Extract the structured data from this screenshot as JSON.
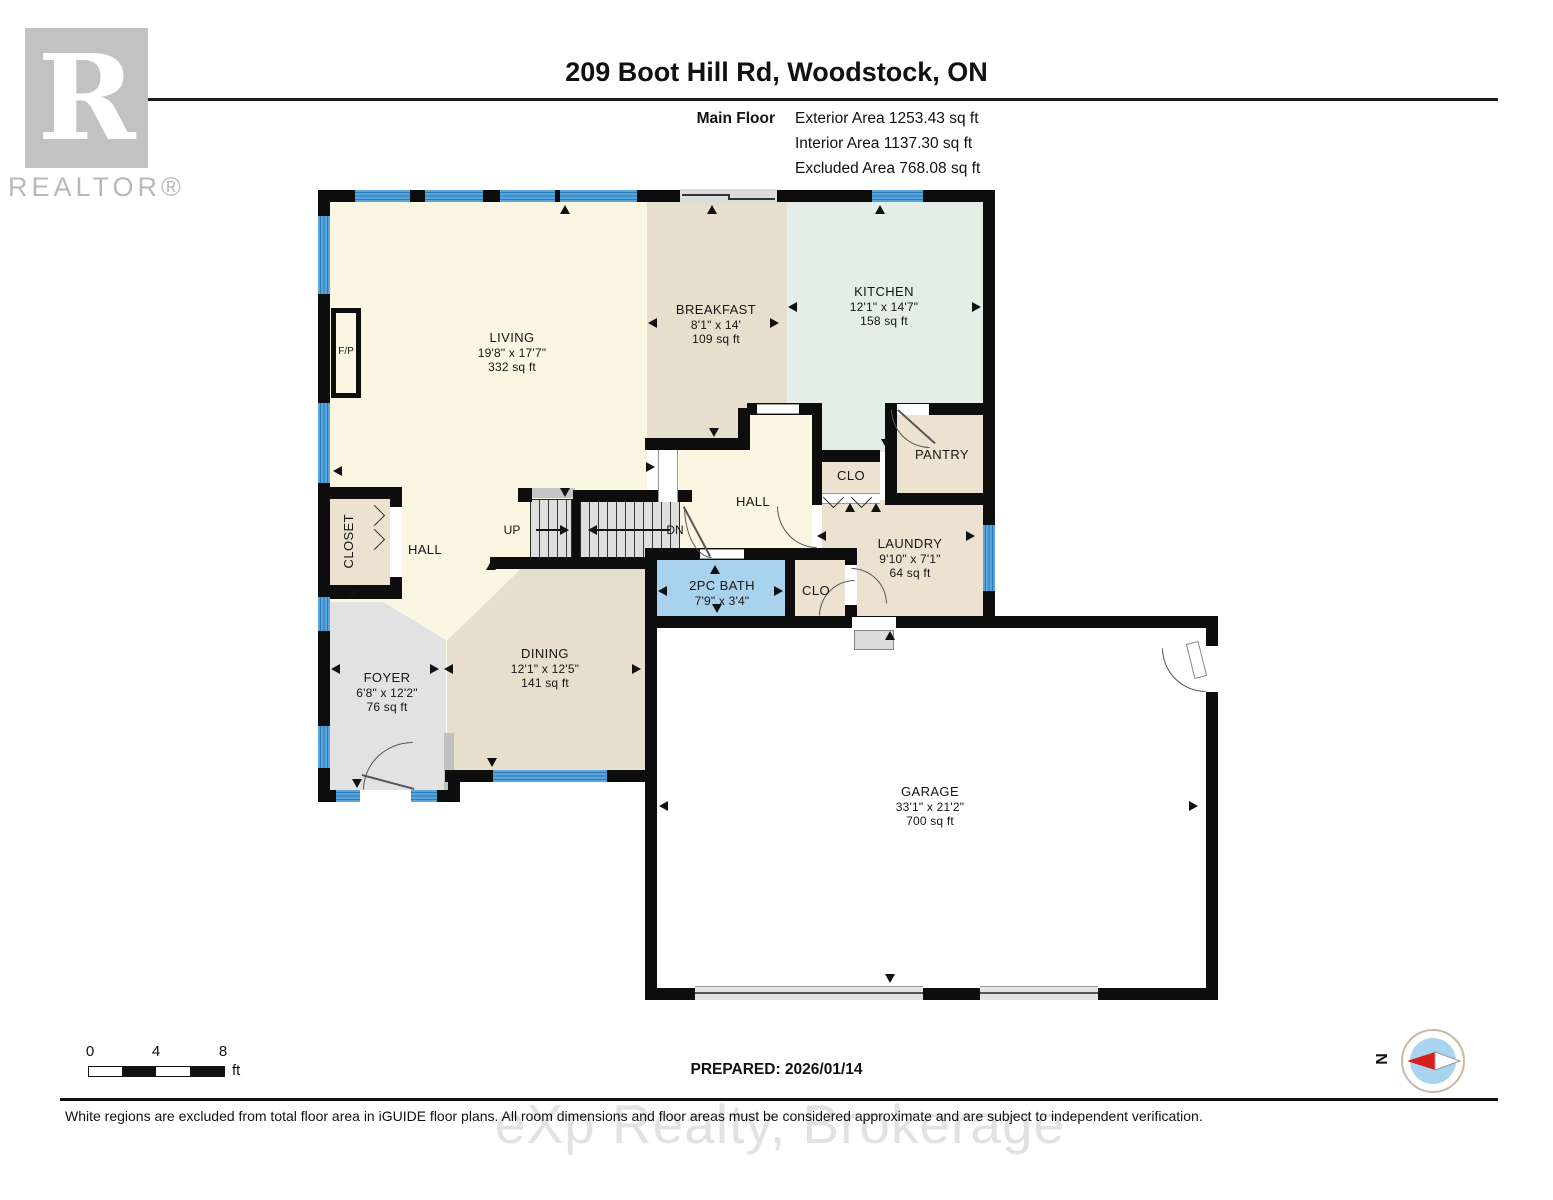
{
  "header": {
    "title": "209 Boot Hill Rd, Woodstock, ON",
    "floor_label": "Main Floor",
    "area_lines": [
      "Exterior Area 1253.43 sq ft",
      "Interior Area 1137.30 sq ft",
      "Excluded Area 768.08 sq ft"
    ]
  },
  "logo": {
    "letter": "R",
    "brand": "REALTOR®"
  },
  "rooms": {
    "living": {
      "name": "LIVING",
      "dims": "19'8\" x 17'7\"",
      "area": "332 sq ft"
    },
    "breakfast": {
      "name": "BREAKFAST",
      "dims": "8'1\" x 14'",
      "area": "109 sq ft"
    },
    "kitchen": {
      "name": "KITCHEN",
      "dims": "12'1\" x 14'7\"",
      "area": "158 sq ft"
    },
    "pantry": {
      "name": "PANTRY"
    },
    "clo_kitchen": {
      "name": "CLO"
    },
    "hall_center": {
      "name": "HALL"
    },
    "laundry": {
      "name": "LAUNDRY",
      "dims": "9'10\" x 7'1\"",
      "area": "64 sq ft"
    },
    "bath": {
      "name": "2PC BATH",
      "dims": "7'9\" x 3'4\""
    },
    "clo_bath": {
      "name": "CLO"
    },
    "hall_left": {
      "name": "HALL"
    },
    "closet": {
      "name": "CLOSET"
    },
    "foyer": {
      "name": "FOYER",
      "dims": "6'8\" x 12'2\"",
      "area": "76 sq ft"
    },
    "dining": {
      "name": "DINING",
      "dims": "12'1\" x 12'5\"",
      "area": "141 sq ft"
    },
    "garage": {
      "name": "GARAGE",
      "dims": "33'1\" x 21'2\"",
      "area": "700 sq ft"
    }
  },
  "stairs": {
    "up": "UP",
    "dn": "DN"
  },
  "fireplace": {
    "label": "F/P"
  },
  "footer": {
    "scale": {
      "start": "0",
      "mid": "4",
      "end": "8",
      "unit": "ft"
    },
    "prepared": "PREPARED: 2026/01/14",
    "compass_n": "N",
    "disclaimer": "White regions are excluded from total floor area in iGUIDE floor plans. All room dimensions and floor areas must be considered approximate and are subject to independent verification.",
    "watermark": "eXp Realty, Brokerage"
  },
  "colors": {
    "wall": "#0d0d0d",
    "window_blue": "#58a5dc",
    "cream": "#faf6e2",
    "tan": "#e7decb",
    "mint": "#e2eee6",
    "beige": "#ece2cf",
    "bath_blue": "#a9d2ee",
    "foyer_gray": "#e2e2e2",
    "stair_gray": "#dedede",
    "garage_white": "#ffffff",
    "compass_red": "#d81f1f",
    "compass_blue": "#a9d3ee"
  }
}
